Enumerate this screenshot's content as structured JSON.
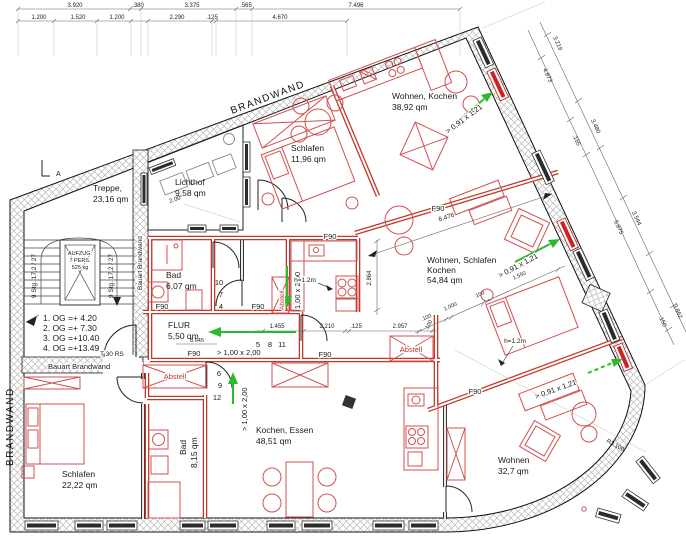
{
  "plan": {
    "brandwand": "BRANDWAND",
    "bauart": "Bauart Brandwand",
    "f90": "F90",
    "abstell": "Abstell",
    "rooms": {
      "treppe": {
        "name": "Treppe,",
        "area": "23,16 qm"
      },
      "lichthof": {
        "name": "Lichthof",
        "area": "9,58 qm"
      },
      "schlafen_tl": {
        "name": "Schlafen",
        "area": "11,96 qm"
      },
      "wohnen_kochen": {
        "name": "Wohnen, Kochen",
        "area": "38,92 qm"
      },
      "bad_mid": {
        "name": "Bad",
        "area": "6,07 qm"
      },
      "flur": {
        "name": "FLUR",
        "area": "5,50 qm"
      },
      "wsk": {
        "line1": "Wohnen, Schlafen",
        "line2": "Kochen",
        "area": "54,84 qm"
      },
      "schlafen_bl": {
        "name": "Schlafen",
        "area": "22,22 qm"
      },
      "bad_bottom": {
        "name": "Bad",
        "area": "8,15 qm"
      },
      "kochen_essen": {
        "name": "Kochen, Essen",
        "area": "48,51 qm"
      },
      "wohnen_br": {
        "name": "Wohnen",
        "area": "32,7 qm"
      }
    },
    "stairs": {
      "flight": "9 Stg. 17,2 / 27",
      "elevator": [
        "AUFZUG:",
        "7 PERS.",
        "525 kg"
      ],
      "door": "T 30 RS",
      "section": "A"
    },
    "levels": [
      "1. OG =+  4.20",
      "2. OG =+  7.30",
      "3. OG =+10.40",
      "4. OG =+13.49"
    ],
    "notes": {
      "win": "> 0,91 x 1,21",
      "door_wide": "> 1,00 x 2,00",
      "door_plain": "1,00 x 2,00",
      "h": "h=1.2m",
      "radius": "R3.100",
      "slope": "2.00"
    },
    "door_numbers": {
      "g1": [
        "10",
        "7",
        "4"
      ],
      "g2": [
        "5",
        "8",
        "11"
      ],
      "g3": [
        "6",
        "9",
        "12"
      ]
    },
    "dims": {
      "row1": [
        "3.920",
        ".380",
        "3.375",
        ".565",
        "7.496"
      ],
      "row2": [
        "1.200",
        "1.520",
        "1.200",
        "2.290",
        ".125",
        "4.670"
      ],
      "right_outer": [
        "3.219",
        "3.480",
        "3.544",
        "3.862"
      ],
      "right_inner": [
        "4.873",
        ".165",
        "6.875",
        ".150"
      ],
      "mid": [
        "1.455",
        "2.210",
        ".125",
        "2.957",
        ".100"
      ],
      "v": "2.864",
      "diag": "6.476",
      "diag2": [
        ".100",
        "1.000",
        ".100",
        "1.550"
      ],
      "flur": "3.645"
    }
  }
}
